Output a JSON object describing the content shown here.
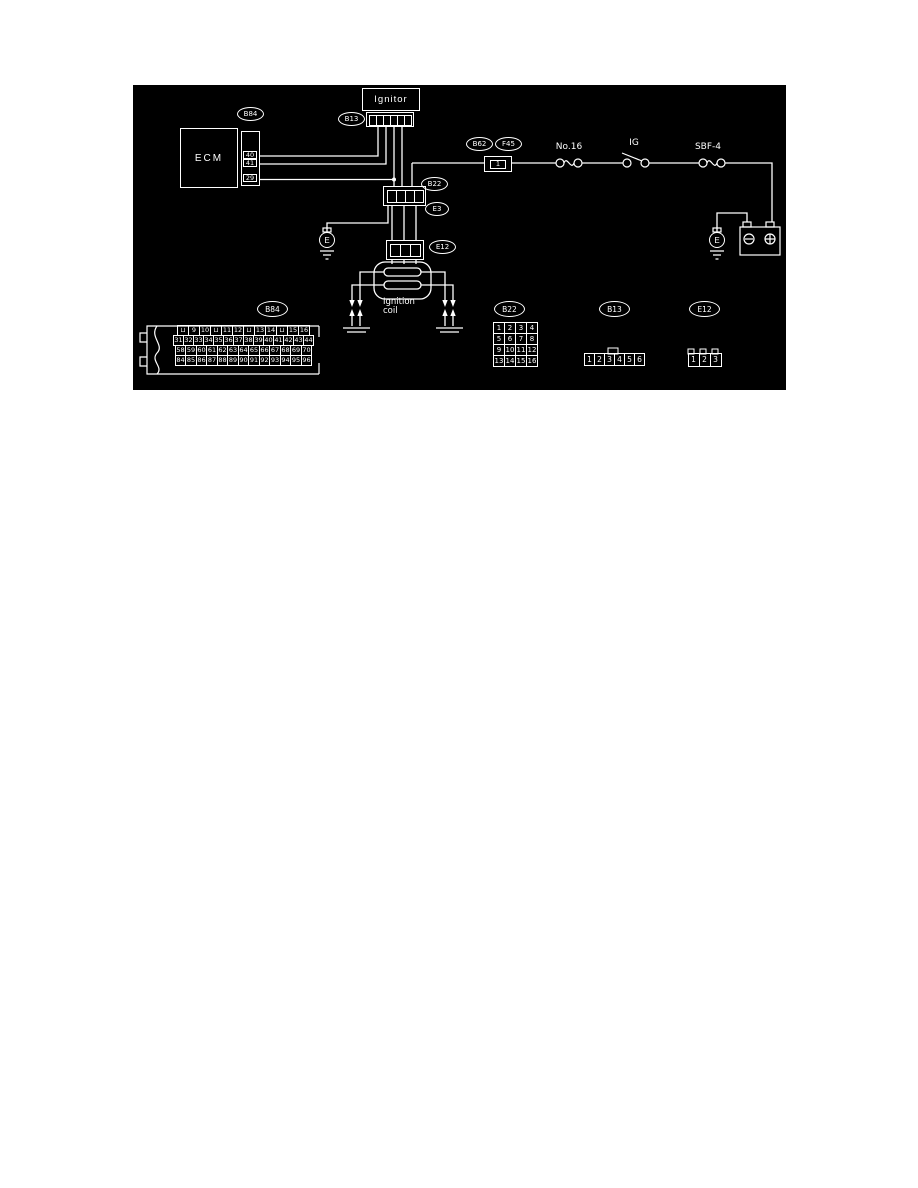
{
  "diagram": {
    "colors": {
      "background": "#000000",
      "line": "#ffffff",
      "page_background": "#ffffff"
    },
    "components": {
      "ecm": "ECM",
      "ignitor": "Ignitor",
      "coil_line1": "Ignition",
      "coil_line2": "coil",
      "fuse_main": "No.16",
      "ignition_switch": "IG",
      "fusible_link": "SBF-4",
      "inline_terminal": "1"
    },
    "ecm_pins": [
      "40",
      "41",
      "29"
    ],
    "connector_refs": {
      "b84_top": "B84",
      "b13_top": "B13",
      "b22_mid": "B22",
      "e3": "E3",
      "e12_mid": "E12",
      "b62": "B62",
      "f45": "F45"
    },
    "grounds": {
      "left": "E",
      "right": "E"
    },
    "inline_pins": {
      "b13": [
        "",
        "",
        "",
        "",
        "",
        ""
      ],
      "b22": [
        "",
        "",
        "",
        ""
      ],
      "e12": [
        "",
        "",
        ""
      ]
    },
    "pinouts": {
      "b84": {
        "ref": "B84",
        "rows": [
          [
            "⊔",
            "9",
            "10",
            "⊔",
            "11",
            "12",
            "⊔",
            "13",
            "14",
            "⊔",
            "15",
            "16"
          ],
          [
            "31",
            "32",
            "33",
            "34",
            "35",
            "36",
            "37",
            "38",
            "39",
            "40",
            "41",
            "42",
            "43",
            "44"
          ],
          [
            "58",
            "59",
            "60",
            "61",
            "62",
            "63",
            "64",
            "65",
            "66",
            "67",
            "68",
            "69",
            "70"
          ],
          [
            "84",
            "85",
            "86",
            "87",
            "88",
            "89",
            "90",
            "91",
            "92",
            "93",
            "94",
            "95",
            "96"
          ]
        ]
      },
      "b22": {
        "ref": "B22",
        "rows": [
          [
            "1",
            "2",
            "3",
            "4"
          ],
          [
            "5",
            "6",
            "7",
            "8"
          ],
          [
            "9",
            "10",
            "11",
            "12"
          ],
          [
            "13",
            "14",
            "15",
            "16"
          ]
        ]
      },
      "b13": {
        "ref": "B13",
        "rows": [
          [
            "1",
            "2",
            "3",
            "4",
            "5",
            "6"
          ]
        ]
      },
      "e12": {
        "ref": "E12",
        "rows": [
          [
            "1",
            "2",
            "3"
          ]
        ]
      }
    }
  }
}
